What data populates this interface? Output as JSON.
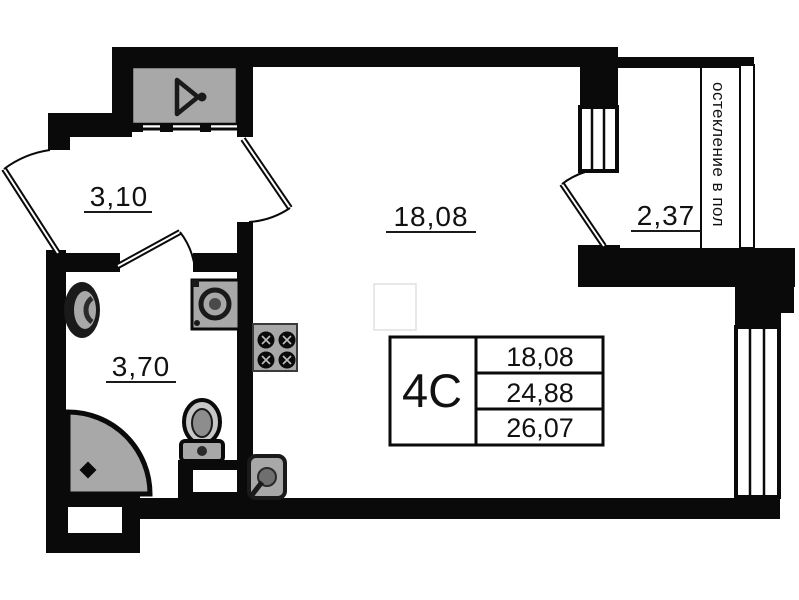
{
  "plan": {
    "title": "studio apartment floor plan",
    "rooms": [
      {
        "id": "hallway",
        "area": "3,10"
      },
      {
        "id": "living-room",
        "area": "18,08"
      },
      {
        "id": "balcony",
        "area": "2,37"
      },
      {
        "id": "bathroom",
        "area": "3,70"
      }
    ],
    "stamp": {
      "type_label": "4С",
      "rows": [
        "18,08",
        "24,88",
        "26,07"
      ]
    },
    "glazing_note": "остекление в пол",
    "colors": {
      "wall": "#0a0a0a",
      "fixture": "#a8a8a8",
      "fixture_dark": "#7d7d7d",
      "paper": "#ffffff"
    }
  }
}
